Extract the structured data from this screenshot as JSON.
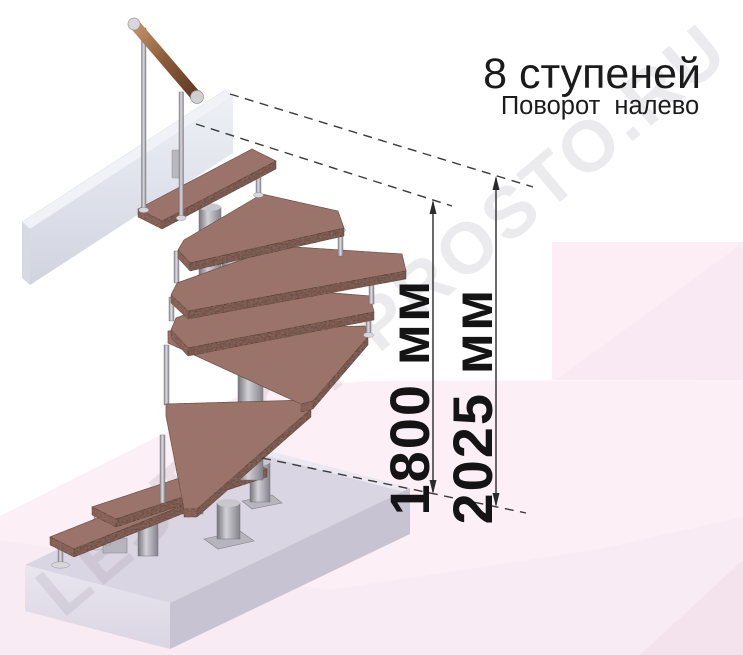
{
  "header": {
    "title": "8 ступеней",
    "subtitle": "Поворот налево"
  },
  "dimensions": {
    "to_top_step": "1800 мм",
    "total_rise": "2025 мм"
  },
  "watermark": {
    "text": "LESTNICY-PROSTO.RU"
  },
  "figure": {
    "steps_visible": 8,
    "type_label": "модульная лестница с поворотом"
  },
  "colors": {
    "wood": "#9c736a",
    "wood_edge": "#6f4d45",
    "metal": "#b3b1b8",
    "floor_pink": "#fcf0f6",
    "platform": "#d9d4e2",
    "upper_slab": "#e9ebf2",
    "ink": "#161616"
  }
}
